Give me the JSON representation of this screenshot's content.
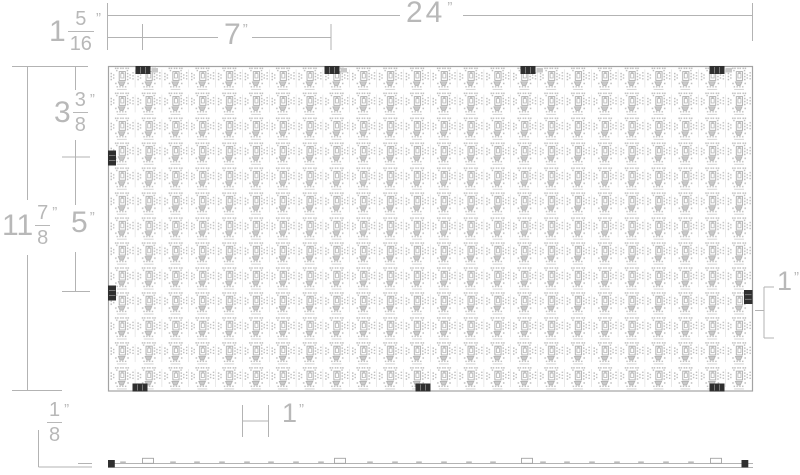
{
  "drawing": {
    "description": "LED PCB panel dimension drawing, top view with side profile",
    "unit_mark": "”"
  },
  "dims": {
    "overall_width": "24",
    "connector_spacing": "7",
    "left_connector_offset": {
      "w": "1",
      "n": "5",
      "d": "16"
    },
    "overall_height": {
      "w": "11",
      "n": "7",
      "d": "8"
    },
    "top_section_height": {
      "w": "3",
      "n": "3",
      "d": "8"
    },
    "mid_section_height": "5",
    "right_segment_height": "1",
    "module_pitch": "1",
    "board_thickness": {
      "n": "1",
      "d": "8"
    }
  },
  "panel": {
    "module_columns": 24,
    "module_rows": 13,
    "edge_connectors": {
      "top": [
        143,
        332,
        528,
        717
      ],
      "left": [
        158,
        293
      ],
      "right": [
        297
      ],
      "bottom": [
        140,
        423,
        717
      ]
    }
  },
  "side_view": {
    "connectors": [
      148,
      340,
      527,
      716
    ],
    "caps": [
      108,
      741.5
    ],
    "bumps": [
      123,
      173,
      197,
      222,
      247,
      271,
      296,
      321,
      370,
      395,
      419,
      444,
      469,
      493,
      543,
      567,
      592,
      617,
      641,
      666,
      691
    ]
  },
  "colors": {
    "line": "#b3b3b3",
    "text": "#b8b8b8",
    "panelBorder": "#a3a3a3",
    "fpDot": "#bcbcbc",
    "fpStroke": "#ababab",
    "fpFill": "#c9c9c9",
    "fpLight": "#d2d2d2",
    "connector": "#2f2f2f"
  }
}
